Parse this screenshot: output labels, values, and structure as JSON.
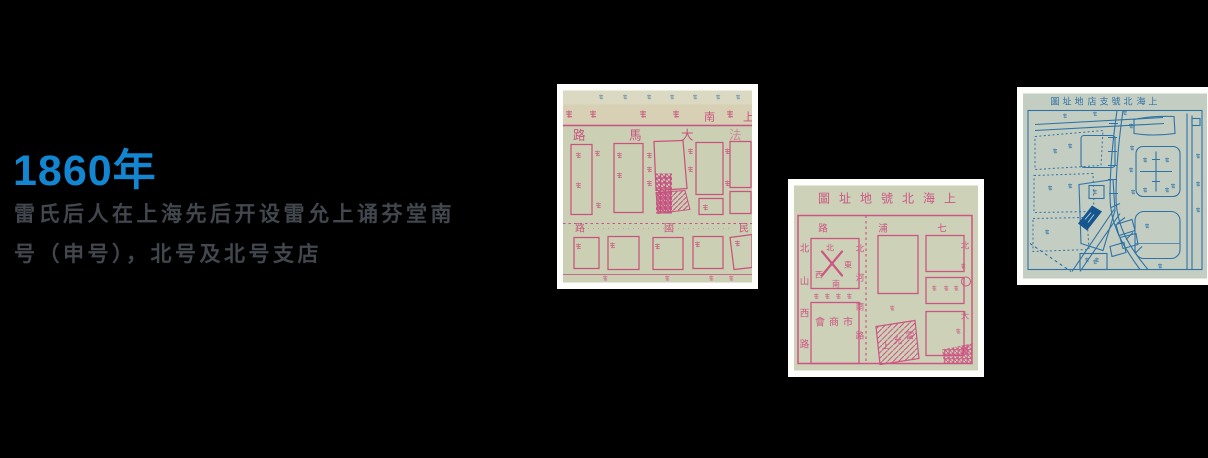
{
  "page": {
    "background": "#000000"
  },
  "entry": {
    "year": "1860年",
    "year_color": "#1286d1",
    "desc_color": "#42474e",
    "desc": {
      "line1": "雷氏后人在上海先后开设雷允上诵芬堂南",
      "line2": "号（申号），北号及北号支店"
    }
  },
  "photos": {
    "south_map": {
      "paper": "#cbd0b4",
      "ink": "#c9527e",
      "band": [
        "南",
        "上"
      ],
      "street_top": [
        "路",
        "馬",
        "大",
        "法"
      ],
      "street_mid": [
        "路",
        "國",
        "民"
      ]
    },
    "north_map": {
      "paper": "#ccd1b7",
      "ink": "#cd5583",
      "title": [
        "圖",
        "址",
        "地",
        "號",
        "北",
        "海",
        "上"
      ],
      "street_top": [
        "路",
        "浦",
        "七"
      ],
      "street_left": [
        "北",
        "山",
        "西",
        "路"
      ],
      "street_center": [
        "北",
        "河",
        "南",
        "路"
      ],
      "compass": {
        "n": "北",
        "e": "東",
        "s": "南",
        "w": "西"
      },
      "chamber": [
        "會",
        "商",
        "市"
      ],
      "shop": [
        "上",
        "允",
        "雷"
      ],
      "right_edge": [
        "北",
        "大",
        "路"
      ]
    },
    "branch_map": {
      "paper": "#c4cdc2",
      "ink": "#2e73a5",
      "marker": "#15568f",
      "title": [
        "圖",
        "址",
        "地",
        "店",
        "支",
        "號",
        "北",
        "海",
        "上"
      ]
    }
  }
}
